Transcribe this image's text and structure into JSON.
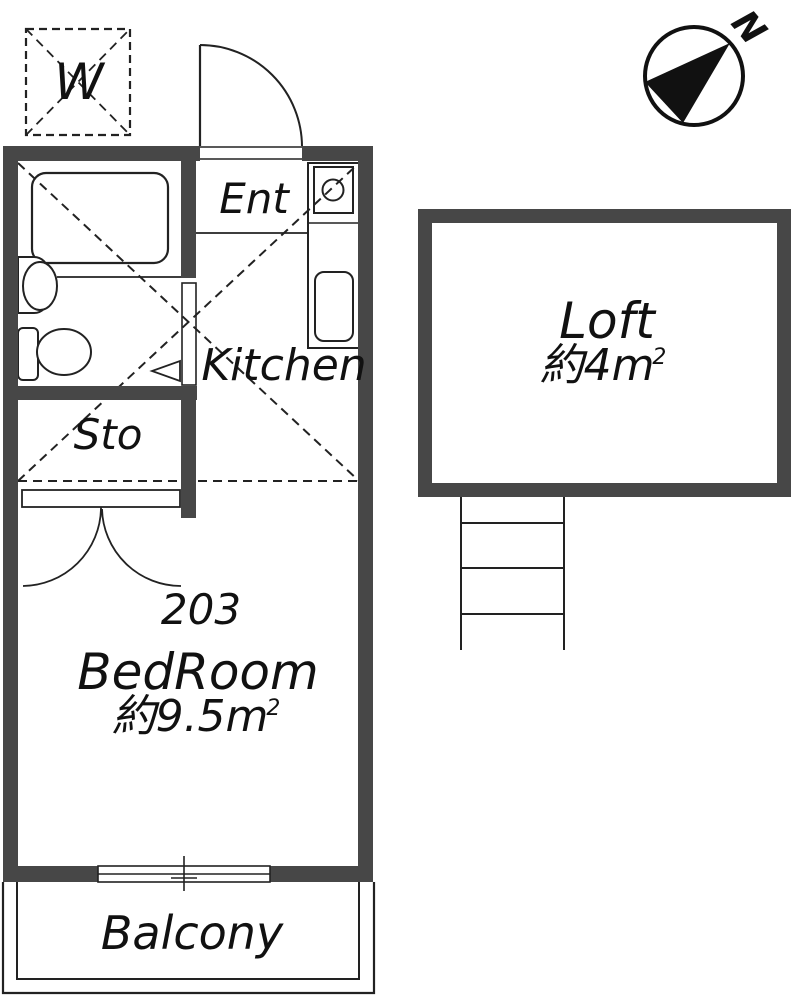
{
  "colors": {
    "wall": "#474747",
    "line": "#222222",
    "text": "#111111"
  },
  "compass": {
    "north_label": "N"
  },
  "washer_box": {
    "label": "W"
  },
  "unit": {
    "entrance_label": "Ent",
    "kitchen_label": "Kitchen",
    "storage_label": "Sto",
    "room_number": "203",
    "bedroom_label": "BedRoom",
    "bedroom_area": "約9.5m",
    "bedroom_area_sup": "2",
    "balcony_label": "Balcony"
  },
  "loft": {
    "label": "Loft",
    "area": "約4m",
    "area_sup": "2"
  }
}
